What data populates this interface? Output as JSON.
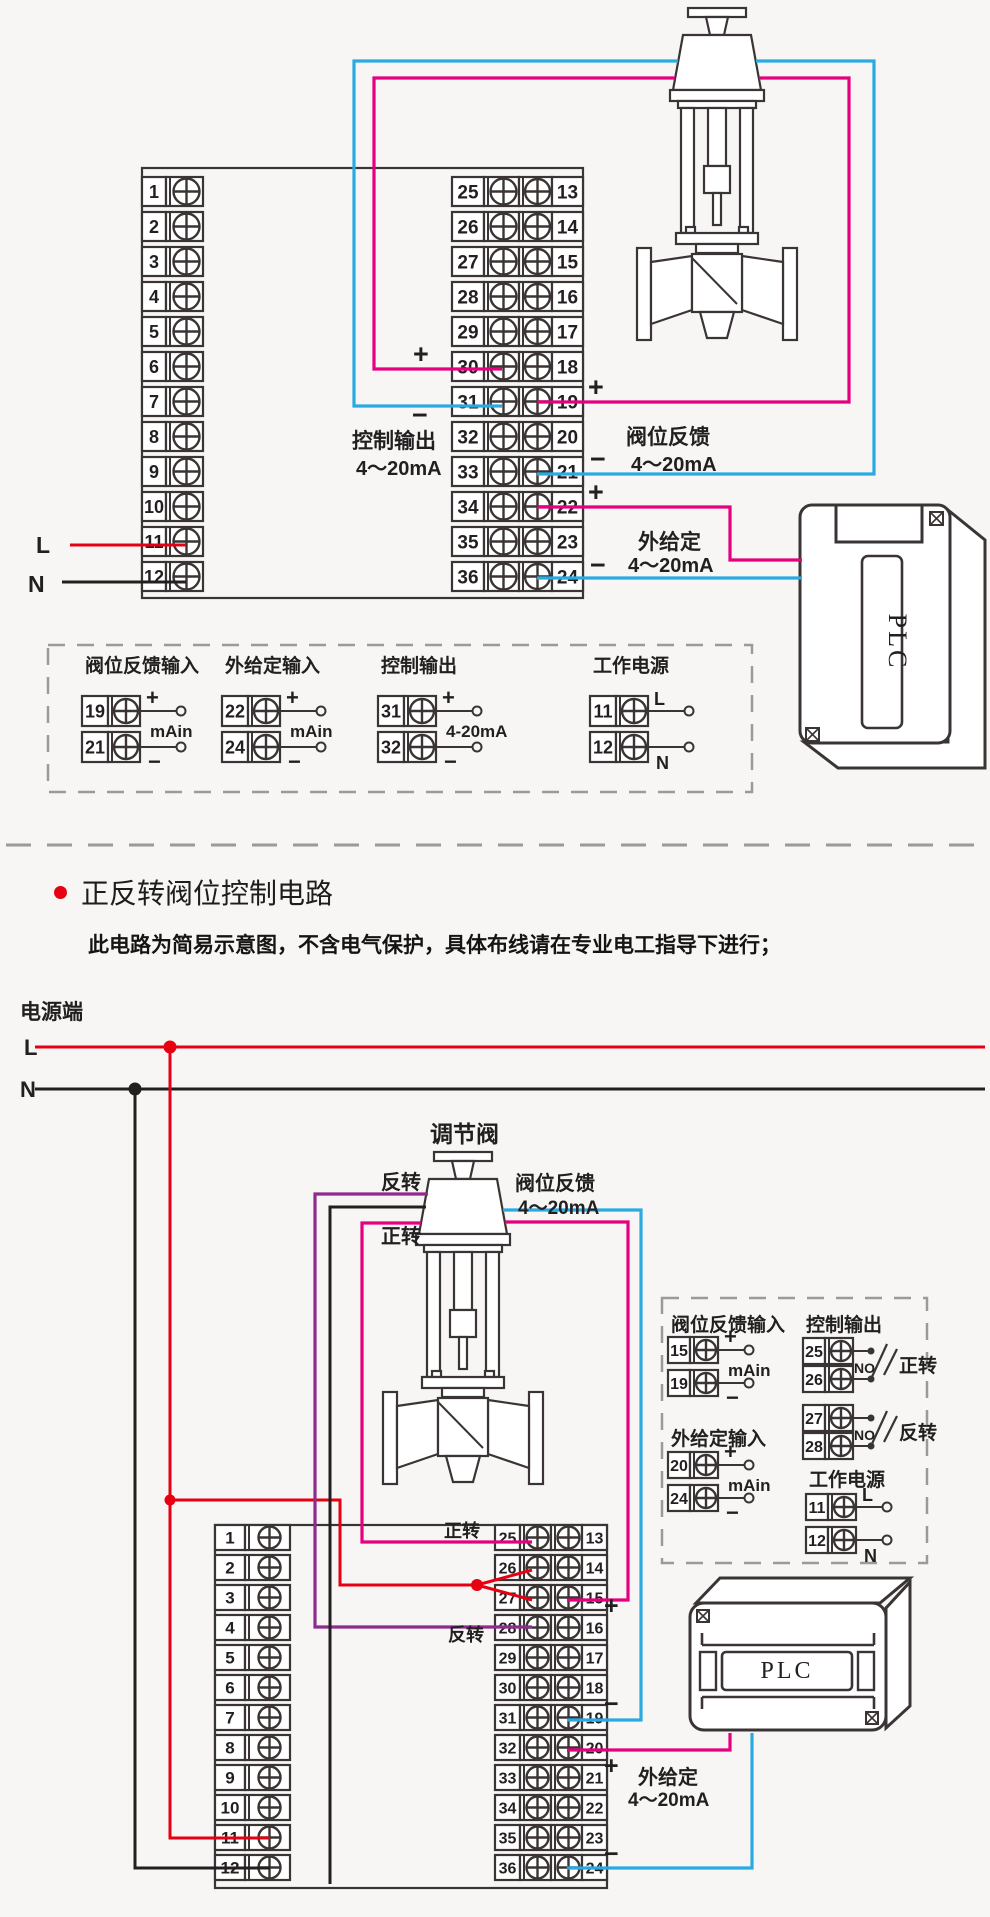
{
  "meta": {
    "bg": "#f7f6f4",
    "ink": "#3a3534",
    "text": "#231f20",
    "gray": "#9a9a9a"
  },
  "wire_colors": {
    "pink": "#e4007f",
    "blue": "#29abe2",
    "red": "#e60012",
    "black": "#231f20",
    "purple": "#8e2b8d"
  },
  "s1": {
    "outline": [
      142,
      168,
      441,
      430
    ],
    "blocks": [
      {
        "x": 142,
        "y0": 177,
        "pitch": 35,
        "h": 29,
        "fs": 18,
        "cols": [
          {
            "t": "num",
            "w": 24,
            "n": 0
          },
          {
            "t": "screw",
            "w": 37
          }
        ],
        "rows": 12,
        "nums": [
          [
            "1",
            "2",
            "3",
            "4",
            "5",
            "6",
            "7",
            "8",
            "9",
            "10",
            "11",
            "12"
          ]
        ]
      },
      {
        "x": 452,
        "y0": 177,
        "pitch": 35,
        "h": 29,
        "fs": 19,
        "cols": [
          {
            "t": "num",
            "w": 32,
            "n": 0
          },
          {
            "t": "screw",
            "w": 35
          },
          {
            "t": "screw",
            "w": 33
          },
          {
            "t": "num",
            "w": 31,
            "n": 1
          }
        ],
        "rows": 12,
        "nums": [
          [
            "25",
            "26",
            "27",
            "28",
            "29",
            "30",
            "31",
            "32",
            "33",
            "34",
            "35",
            "36"
          ],
          [
            "13",
            "14",
            "15",
            "16",
            "17",
            "18",
            "19",
            "20",
            "21",
            "22",
            "23",
            "24"
          ]
        ]
      }
    ],
    "valve": {
      "cx": 717,
      "ty": 8
    },
    "plc": {
      "x": 800,
      "y": 505,
      "label": "PLC"
    },
    "wires": [
      {
        "c": "pink",
        "w": 3.2,
        "pts": [
          [
            502,
            369
          ],
          [
            374,
            369
          ],
          [
            374,
            78
          ],
          [
            675,
            78
          ]
        ]
      },
      {
        "c": "pink",
        "w": 3.2,
        "pts": [
          [
            759,
            78
          ],
          [
            849,
            78
          ],
          [
            849,
            402
          ],
          [
            537,
            402
          ]
        ]
      },
      {
        "c": "blue",
        "w": 3.2,
        "pts": [
          [
            502,
            406
          ],
          [
            354,
            406
          ],
          [
            354,
            61
          ],
          [
            678,
            61
          ]
        ]
      },
      {
        "c": "blue",
        "w": 3.2,
        "pts": [
          [
            756,
            61
          ],
          [
            874,
            61
          ],
          [
            874,
            474
          ],
          [
            537,
            474
          ]
        ]
      },
      {
        "c": "pink",
        "w": 3.2,
        "pts": [
          [
            537,
            507
          ],
          [
            730,
            507
          ],
          [
            730,
            560
          ],
          [
            802,
            560
          ]
        ]
      },
      {
        "c": "blue",
        "w": 3.2,
        "pts": [
          [
            537,
            578
          ],
          [
            802,
            578
          ]
        ]
      },
      {
        "c": "red",
        "w": 3,
        "pts": [
          [
            70,
            545
          ],
          [
            186,
            545
          ]
        ]
      },
      {
        "c": "black",
        "w": 3,
        "pts": [
          [
            62,
            582
          ],
          [
            186,
            582
          ]
        ]
      }
    ],
    "labels": [
      {
        "t": "+",
        "x": 413,
        "y": 363,
        "s": 27,
        "w": 700
      },
      {
        "t": "−",
        "x": 412,
        "y": 424,
        "s": 27,
        "w": 700
      },
      {
        "t": "控制输出",
        "x": 352,
        "y": 448,
        "s": 21,
        "w": 600
      },
      {
        "t": "4～20mA",
        "x": 356,
        "y": 475,
        "s": 20,
        "w": 600
      },
      {
        "t": "+",
        "x": 588,
        "y": 396,
        "s": 27,
        "w": 700
      },
      {
        "t": "−",
        "x": 590,
        "y": 468,
        "s": 27,
        "w": 700
      },
      {
        "t": "阀位反馈",
        "x": 626,
        "y": 444,
        "s": 21,
        "w": 600
      },
      {
        "t": "4～20mA",
        "x": 631,
        "y": 471,
        "s": 20,
        "w": 600
      },
      {
        "t": "+",
        "x": 588,
        "y": 501,
        "s": 27,
        "w": 700
      },
      {
        "t": "−",
        "x": 590,
        "y": 574,
        "s": 27,
        "w": 700
      },
      {
        "t": "外给定",
        "x": 638,
        "y": 549,
        "s": 21,
        "w": 600
      },
      {
        "t": "4～20mA",
        "x": 628,
        "y": 572,
        "s": 20,
        "w": 600
      },
      {
        "t": "L",
        "x": 36,
        "y": 553,
        "s": 23,
        "c": "red",
        "w": 700
      },
      {
        "t": "N",
        "x": 28,
        "y": 592,
        "s": 23,
        "w": 700
      }
    ],
    "legend": {
      "box": [
        48,
        645,
        704,
        147
      ],
      "geo": {
        "numW": 26,
        "screwW": 32,
        "h": 30,
        "lead": 36,
        "fs": 18
      },
      "groups": [
        {
          "x": 82,
          "ty": 672,
          "title": "阀位反馈输入",
          "rows": [
            [
              "19",
              "+",
              696
            ],
            [
              "21",
              "−",
              732
            ]
          ],
          "note": "mAin",
          "note_y": 731
        },
        {
          "x": 222,
          "ty": 672,
          "title": "外给定输入",
          "rows": [
            [
              "22",
              "+",
              696
            ],
            [
              "24",
              "−",
              732
            ]
          ],
          "note": "mAin",
          "note_y": 731
        },
        {
          "x": 378,
          "ty": 672,
          "title": "控制输出",
          "rows": [
            [
              "31",
              "+",
              696
            ],
            [
              "32",
              "−",
              732
            ]
          ],
          "note": "4-20mA",
          "note_y": 731
        },
        {
          "x": 590,
          "ty": 672,
          "title": "工作电源",
          "rows": [
            [
              "11",
              "L",
              696
            ],
            [
              "12",
              "N",
              732
            ]
          ],
          "note": "",
          "note_y": 0
        }
      ]
    }
  },
  "divider": {
    "y": 845,
    "x1": 6,
    "x2": 984
  },
  "s2": {
    "heading": "正反转阀位控制电路",
    "sub": "此电路为简易示意图，不含电气保护，具体布线请在专业电工指导下进行；",
    "outline": [
      215,
      1525,
      392,
      363
    ],
    "blocks": [
      {
        "x": 215,
        "y0": 1525,
        "pitch": 30,
        "h": 25,
        "fs": 17,
        "cols": [
          {
            "t": "num",
            "w": 30,
            "n": 0
          },
          {
            "t": "screw",
            "w": 45
          }
        ],
        "rows": 12,
        "nums": [
          [
            "1",
            "2",
            "3",
            "4",
            "5",
            "6",
            "7",
            "8",
            "9",
            "10",
            "11",
            "12"
          ]
        ]
      },
      {
        "x": 495,
        "y0": 1525,
        "pitch": 30,
        "h": 25,
        "fs": 16,
        "cols": [
          {
            "t": "num",
            "w": 25,
            "n": 0
          },
          {
            "t": "screw",
            "w": 31
          },
          {
            "t": "screw",
            "w": 31
          },
          {
            "t": "num",
            "w": 25,
            "n": 1
          }
        ],
        "rows": 12,
        "nums": [
          [
            "25",
            "26",
            "27",
            "28",
            "29",
            "30",
            "31",
            "32",
            "33",
            "34",
            "35",
            "36"
          ],
          [
            "13",
            "14",
            "15",
            "16",
            "17",
            "18",
            "19",
            "20",
            "21",
            "22",
            "23",
            "24"
          ]
        ]
      }
    ],
    "valve": {
      "cx": 463,
      "ty": 1152
    },
    "plc": {
      "x": 690,
      "y": 1578,
      "label": "PLC"
    },
    "wires": [
      {
        "c": "red",
        "w": 3,
        "pts": [
          [
            35,
            1047
          ],
          [
            985,
            1047
          ]
        ]
      },
      {
        "c": "black",
        "w": 3,
        "pts": [
          [
            35,
            1089
          ],
          [
            985,
            1089
          ]
        ]
      },
      {
        "c": "red",
        "w": 3,
        "pts": [
          [
            170,
            1047
          ],
          [
            170,
            1838
          ],
          [
            270,
            1838
          ]
        ]
      },
      {
        "c": "black",
        "w": 3,
        "pts": [
          [
            135,
            1089
          ],
          [
            135,
            1868
          ],
          [
            270,
            1868
          ]
        ]
      },
      {
        "c": "red",
        "w": 3,
        "pts": [
          [
            170,
            1500
          ],
          [
            340,
            1500
          ],
          [
            340,
            1585
          ],
          [
            477,
            1585
          ]
        ]
      },
      {
        "c": "red",
        "w": 3,
        "pts": [
          [
            477,
            1585
          ],
          [
            532,
            1570
          ]
        ]
      },
      {
        "c": "red",
        "w": 3,
        "pts": [
          [
            477,
            1585
          ],
          [
            532,
            1600
          ]
        ]
      },
      {
        "c": "purple",
        "w": 3.2,
        "pts": [
          [
            428,
            1194
          ],
          [
            315,
            1194
          ],
          [
            315,
            1627
          ],
          [
            532,
            1627
          ]
        ]
      },
      {
        "c": "black",
        "w": 3,
        "pts": [
          [
            426,
            1207
          ],
          [
            330,
            1207
          ],
          [
            330,
            1884
          ]
        ]
      },
      {
        "c": "pink",
        "w": 3.2,
        "pts": [
          [
            421,
            1223
          ],
          [
            362,
            1223
          ],
          [
            362,
            1542
          ],
          [
            532,
            1542
          ]
        ]
      },
      {
        "c": "pink",
        "w": 3.2,
        "pts": [
          [
            505,
            1222
          ],
          [
            628,
            1222
          ],
          [
            628,
            1600
          ],
          [
            567,
            1600
          ]
        ]
      },
      {
        "c": "blue",
        "w": 3.2,
        "pts": [
          [
            503,
            1210
          ],
          [
            641,
            1210
          ],
          [
            641,
            1720
          ],
          [
            567,
            1720
          ]
        ]
      },
      {
        "c": "pink",
        "w": 3.2,
        "pts": [
          [
            567,
            1750
          ],
          [
            730,
            1750
          ],
          [
            730,
            1733
          ]
        ]
      },
      {
        "c": "blue",
        "w": 3.2,
        "pts": [
          [
            567,
            1868
          ],
          [
            752,
            1868
          ],
          [
            752,
            1733
          ]
        ]
      }
    ],
    "dots": [
      {
        "x": 170,
        "y": 1047,
        "c": "red",
        "r": 6.5
      },
      {
        "x": 135,
        "y": 1089,
        "c": "black",
        "r": 6.5
      },
      {
        "x": 170,
        "y": 1500,
        "c": "red",
        "r": 5.5
      },
      {
        "x": 477,
        "y": 1585,
        "c": "red",
        "r": 6
      }
    ],
    "labels": [
      {
        "t": "电源端",
        "x": 20,
        "y": 1019,
        "s": 21,
        "w": 600
      },
      {
        "t": "L",
        "x": 24,
        "y": 1055,
        "s": 22,
        "c": "red",
        "w": 700
      },
      {
        "t": "N",
        "x": 20,
        "y": 1097,
        "s": 22,
        "w": 700
      },
      {
        "t": "调节阀",
        "x": 430,
        "y": 1142,
        "s": 23,
        "w": 600
      },
      {
        "t": "反转",
        "x": 381,
        "y": 1189,
        "s": 20,
        "w": 600
      },
      {
        "t": "正转",
        "x": 381,
        "y": 1243,
        "s": 20,
        "w": 600
      },
      {
        "t": "阀位反馈",
        "x": 515,
        "y": 1190,
        "s": 20,
        "w": 600
      },
      {
        "t": "4～20mA",
        "x": 518,
        "y": 1214,
        "s": 19,
        "w": 600
      },
      {
        "t": "正转",
        "x": 444,
        "y": 1537,
        "s": 18,
        "w": 600
      },
      {
        "t": "反转",
        "x": 448,
        "y": 1641,
        "s": 18,
        "w": 600
      },
      {
        "t": "+",
        "x": 604,
        "y": 1614,
        "s": 25,
        "w": 700
      },
      {
        "t": "−",
        "x": 604,
        "y": 1712,
        "s": 25,
        "w": 700
      },
      {
        "t": "+",
        "x": 604,
        "y": 1774,
        "s": 25,
        "w": 700
      },
      {
        "t": "−",
        "x": 604,
        "y": 1862,
        "s": 25,
        "w": 700
      },
      {
        "t": "外给定",
        "x": 638,
        "y": 1784,
        "s": 20,
        "w": 600
      },
      {
        "t": "4～20mA",
        "x": 628,
        "y": 1806,
        "s": 19,
        "w": 600
      }
    ],
    "legend": {
      "box": [
        662,
        1298,
        265,
        265
      ],
      "geo": {
        "numW": 22,
        "screwW": 28,
        "h": 26,
        "lead": 26,
        "fs": 16
      },
      "groups": [
        {
          "x": 668,
          "ty": 1331,
          "title": "阀位反馈输入",
          "rows": [
            [
              "15",
              "+",
              1337
            ],
            [
              "19",
              "−",
              1370
            ]
          ],
          "note": "mAin",
          "note_y": 1370
        },
        {
          "x": 668,
          "ty": 1445,
          "title": "外给定输入",
          "rows": [
            [
              "20",
              "+",
              1452
            ],
            [
              "24",
              "−",
              1485
            ]
          ],
          "note": "mAin",
          "note_y": 1485
        },
        {
          "x": 806,
          "ty": 1486,
          "title": "工作电源",
          "rows": [
            [
              "11",
              "L",
              1494
            ],
            [
              "12",
              "N",
              1527
            ]
          ],
          "note": "",
          "note_y": 0
        }
      ],
      "pairs_group": {
        "x": 803,
        "ty": 1331,
        "title": "控制输出",
        "no": "NO",
        "pairs": [
          {
            "y": 1338,
            "nums": [
              "25",
              "26"
            ],
            "label": "正转"
          },
          {
            "y": 1405,
            "nums": [
              "27",
              "28"
            ],
            "label": "反转"
          }
        ]
      }
    }
  }
}
